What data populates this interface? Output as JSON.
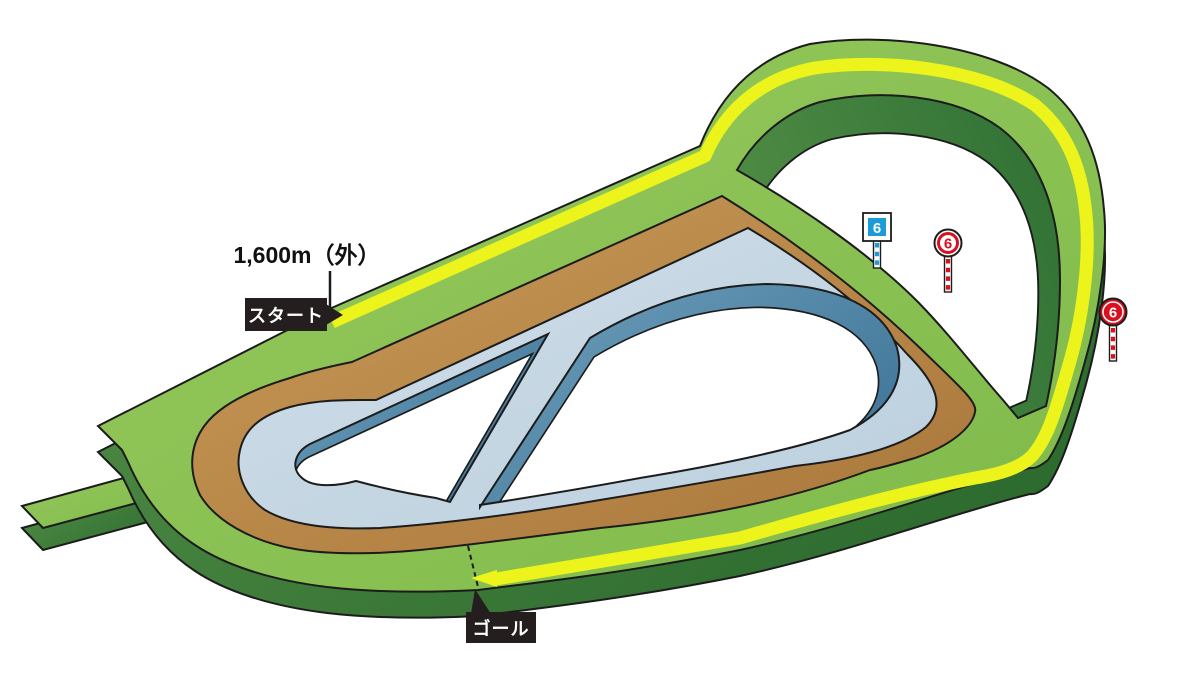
{
  "diagram": {
    "kind": "racecourse-course-map",
    "distance_label": "1,600m（外）",
    "start_label": "スタート",
    "goal_label": "ゴール",
    "markers": [
      {
        "value": "6",
        "style": "blue-square-pole",
        "color": "#1b9bd8"
      },
      {
        "value": "6",
        "style": "red-circle-outline-pole",
        "color": "#d8101f"
      },
      {
        "value": "6",
        "style": "red-circle-filled-pole",
        "color": "#d8101f"
      }
    ],
    "colors": {
      "turf_green": "#8cc253",
      "turf_side_dark_green": "#2e6c2f",
      "dirt_brown": "#b98a46",
      "inner_track_blue": "#c8d9e4",
      "inner_wall_blue": "#44789c",
      "route_yellow": "#edf41b",
      "label_background": "#241f1e",
      "outline_black": "#1c1c1c"
    }
  }
}
